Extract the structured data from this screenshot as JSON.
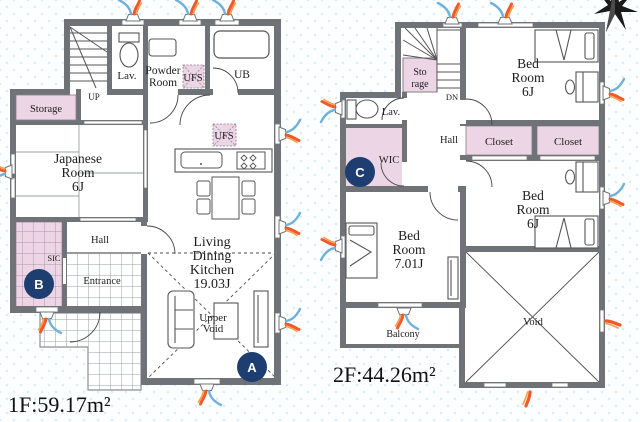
{
  "colors": {
    "wall": "#6f7378",
    "pink": "#ecd5e4",
    "pink_line": "#b295ab",
    "navy_marker": "#1e3e71",
    "flame_blue": "#6fb1da",
    "flame_orange": "#f05a28",
    "flame_light": "#f99d4b"
  },
  "compass": {
    "icon": "north-star"
  },
  "floor1": {
    "area_label": "1F:59.17m²",
    "stairs_label": "UP",
    "lav": "Lav.",
    "powder_line1": "Powder",
    "powder_line2": "Room",
    "ufs_bath": "UFS",
    "ub": "UB",
    "storage": "Storage",
    "japanese_line1": "Japanese",
    "japanese_line2": "Room",
    "japanese_line3": "6J",
    "ufs_kitchen": "UFS",
    "hall": "Hall",
    "sic": "SIC",
    "entrance": "Entrance",
    "ldk_line1": "Living",
    "ldk_line2": "Dining",
    "ldk_line3": "Kitchen",
    "ldk_line4": "19.03J",
    "upper_void_line1": "Upper",
    "upper_void_line2": "Void",
    "marker_a": "A",
    "marker_b": "B"
  },
  "floor2": {
    "area_label": "2F:44.26m²",
    "stairs_label": "DN",
    "storage_line1": "Sto",
    "storage_line2": "rage",
    "lav": "Lav.",
    "wic": "WIC",
    "hall": "Hall",
    "bedroom1_line1": "Bed",
    "bedroom1_line2": "Room",
    "bedroom1_line3": "6J",
    "closet1": "Closet",
    "closet2": "Closet",
    "bedroom2_line1": "Bed",
    "bedroom2_line2": "Room",
    "bedroom2_line3": "6J",
    "bedroom3_line1": "Bed",
    "bedroom3_line2": "Room",
    "bedroom3_line3": "7.01J",
    "balcony": "Balcony",
    "void": "Void",
    "marker_c": "C"
  }
}
